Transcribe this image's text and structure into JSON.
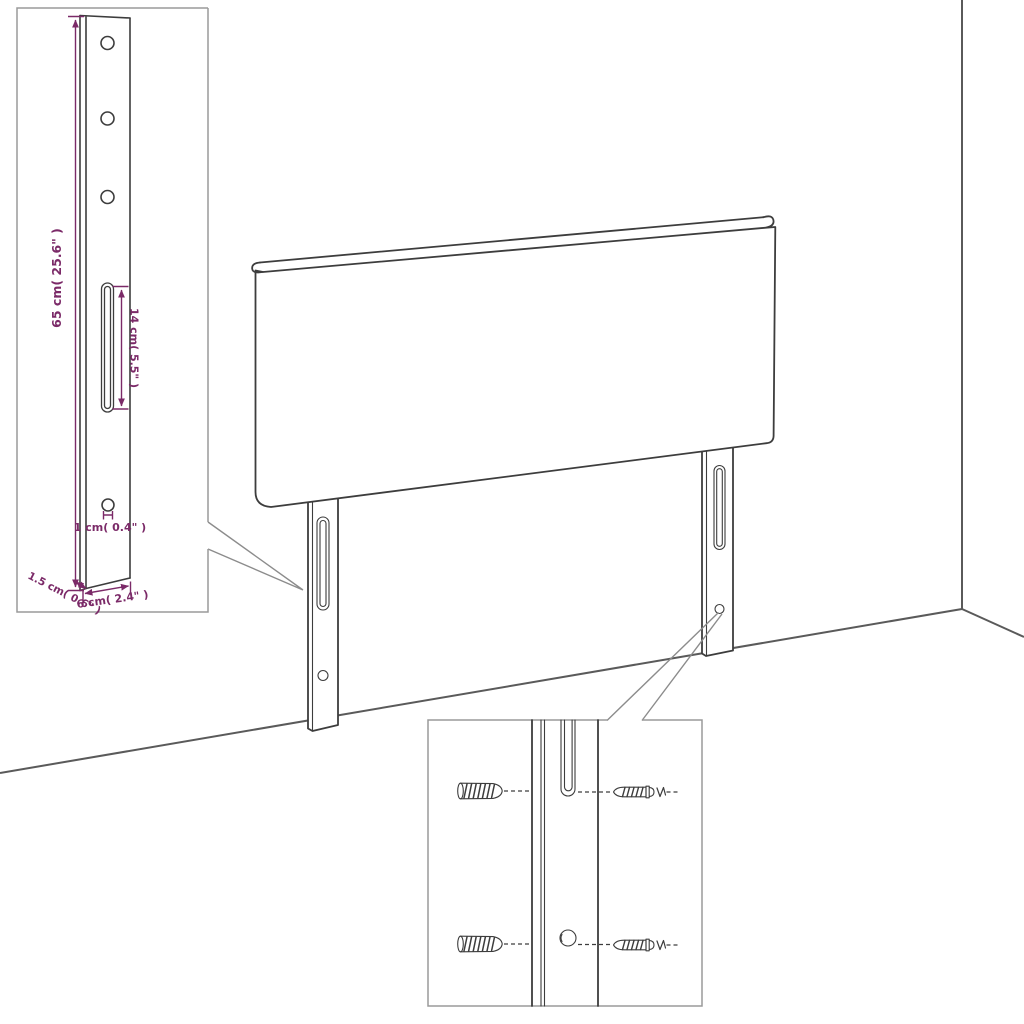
{
  "app": {
    "name": "headboard-assembly-dimension-diagram",
    "background": "#ffffff"
  },
  "colors": {
    "drawing_line": "#3d3d3d",
    "room_line": "#5a5a5a",
    "inset_border": "#9a9a9a",
    "callout_line": "#8c8c8c",
    "dimension": "#7b2a68"
  },
  "labels": {
    "bracket_height": "65 cm( 25.6\" )",
    "slot_length": "14 cm( 5.5\" )",
    "hole_diameter": "1 cm( 0.4\" )",
    "bracket_thickness": "1.5 cm( 0.6\" )",
    "bracket_width": "6 cm( 2.4\" )"
  }
}
